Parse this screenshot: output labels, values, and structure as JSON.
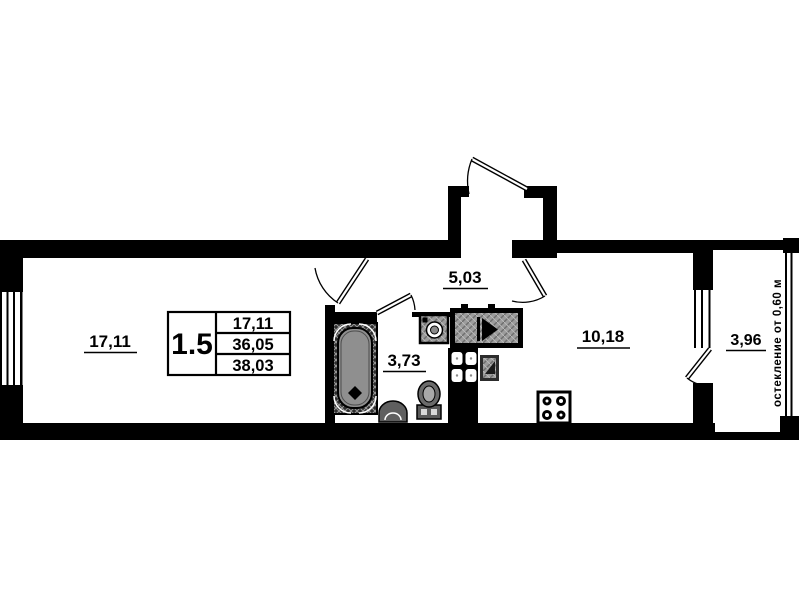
{
  "labels": {
    "room": "17,11",
    "hallway": "5,03",
    "bathroom": "3,73",
    "kitchen": "10,18",
    "balcony": "3,96"
  },
  "info_table": {
    "left_value": "1.5",
    "rows": [
      "17,11",
      "36,05",
      "38,03"
    ]
  },
  "balcony_note": "остекление от 0,60 м",
  "colors": {
    "wall": "#000000",
    "background": "#ffffff",
    "fixture_grey": "#8f8f8f"
  }
}
